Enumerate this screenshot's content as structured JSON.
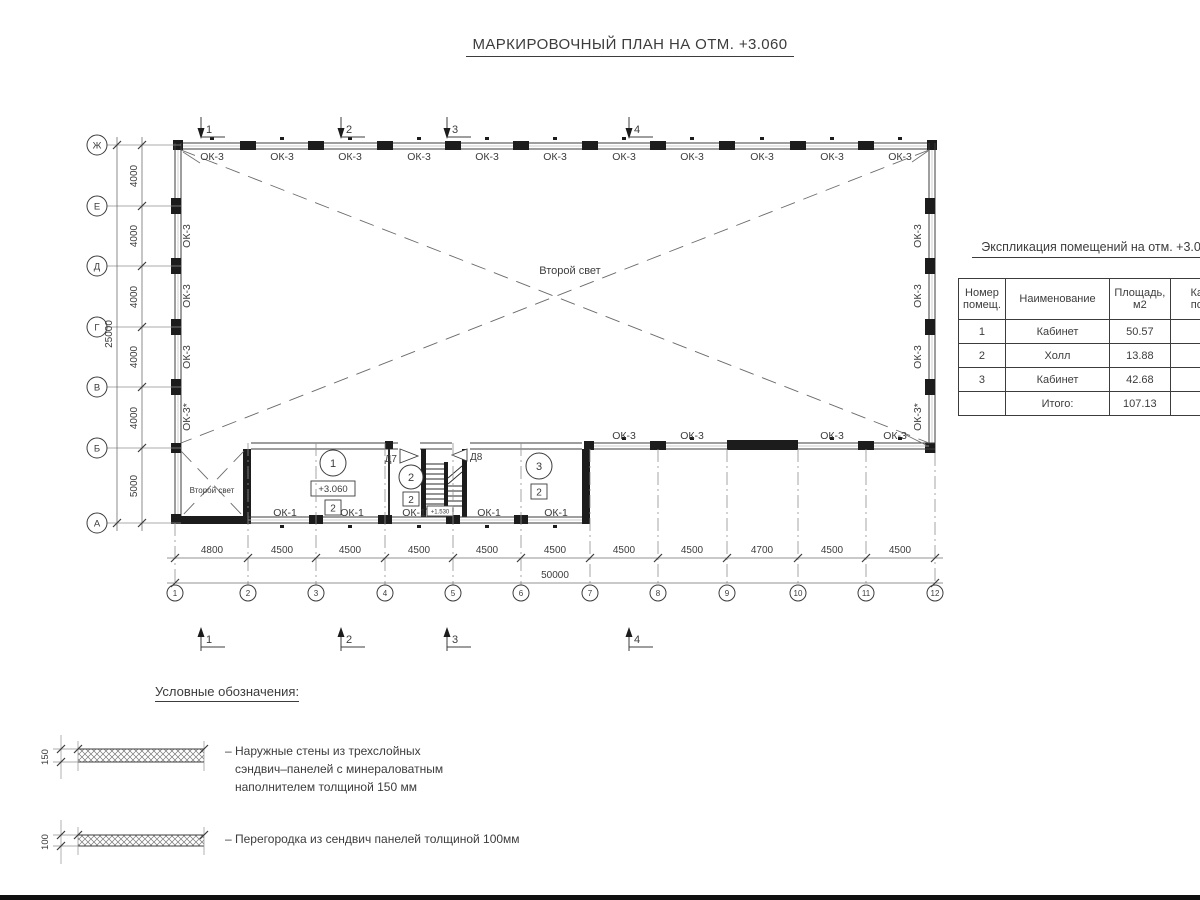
{
  "title": "МАРКИРОВОЧНЫЙ ПЛАН НА ОТМ. +3.060",
  "plan": {
    "second_light": "Второй свет",
    "ok3": "ОК-3",
    "ok3_star": "ОК-3*",
    "ok1": "ОК-1",
    "d7": "Д7",
    "d8": "Д8",
    "stair_elevation": "+1.530",
    "rooms": {
      "r1": {
        "number": "1",
        "elevation": "+3.060",
        "category": "2"
      },
      "r2": {
        "number": "2",
        "category": "2"
      },
      "r3": {
        "number": "3",
        "category": "2"
      }
    },
    "grid_rows": [
      "Ж",
      "Е",
      "Д",
      "Г",
      "В",
      "Б",
      "А"
    ],
    "grid_cols": [
      "1",
      "2",
      "3",
      "4",
      "5",
      "6",
      "7",
      "8",
      "9",
      "10",
      "11",
      "12"
    ],
    "dims_left": [
      "4000",
      "4000",
      "4000",
      "4000",
      "4000",
      "5000"
    ],
    "dim_left_total": "25000",
    "dims_bottom": [
      "4800",
      "4500",
      "4500",
      "4500",
      "4500",
      "4500",
      "4500",
      "4500",
      "4700",
      "4500",
      "4500"
    ],
    "dim_bottom_total": "50000",
    "sections": [
      "1",
      "2",
      "3",
      "4"
    ]
  },
  "table": {
    "title": "Экспликация помещений на отм. +3.060",
    "headers": {
      "number": "Номер помещ.",
      "name": "Наименование",
      "area": "Площадь, м2",
      "cut_line1": "Ка",
      "cut_line2": "по"
    },
    "rows": [
      {
        "number": "1",
        "name": "Кабинет",
        "area": "50.57"
      },
      {
        "number": "2",
        "name": "Холл",
        "area": "13.88"
      },
      {
        "number": "3",
        "name": "Кабинет",
        "area": "42.68"
      }
    ],
    "total_label": "Итого:",
    "total_value": "107.13"
  },
  "legend": {
    "title": "Условные обозначения:",
    "items": [
      {
        "dim": "150",
        "lines": [
          "– Наружные стены из трехслойных",
          "сэндвич–панелей с минераловатным",
          "наполнителем толщиной 150 мм"
        ]
      },
      {
        "dim": "100",
        "lines": [
          "– Перегородка из сендвич панелей толщиной 100мм"
        ]
      }
    ]
  }
}
